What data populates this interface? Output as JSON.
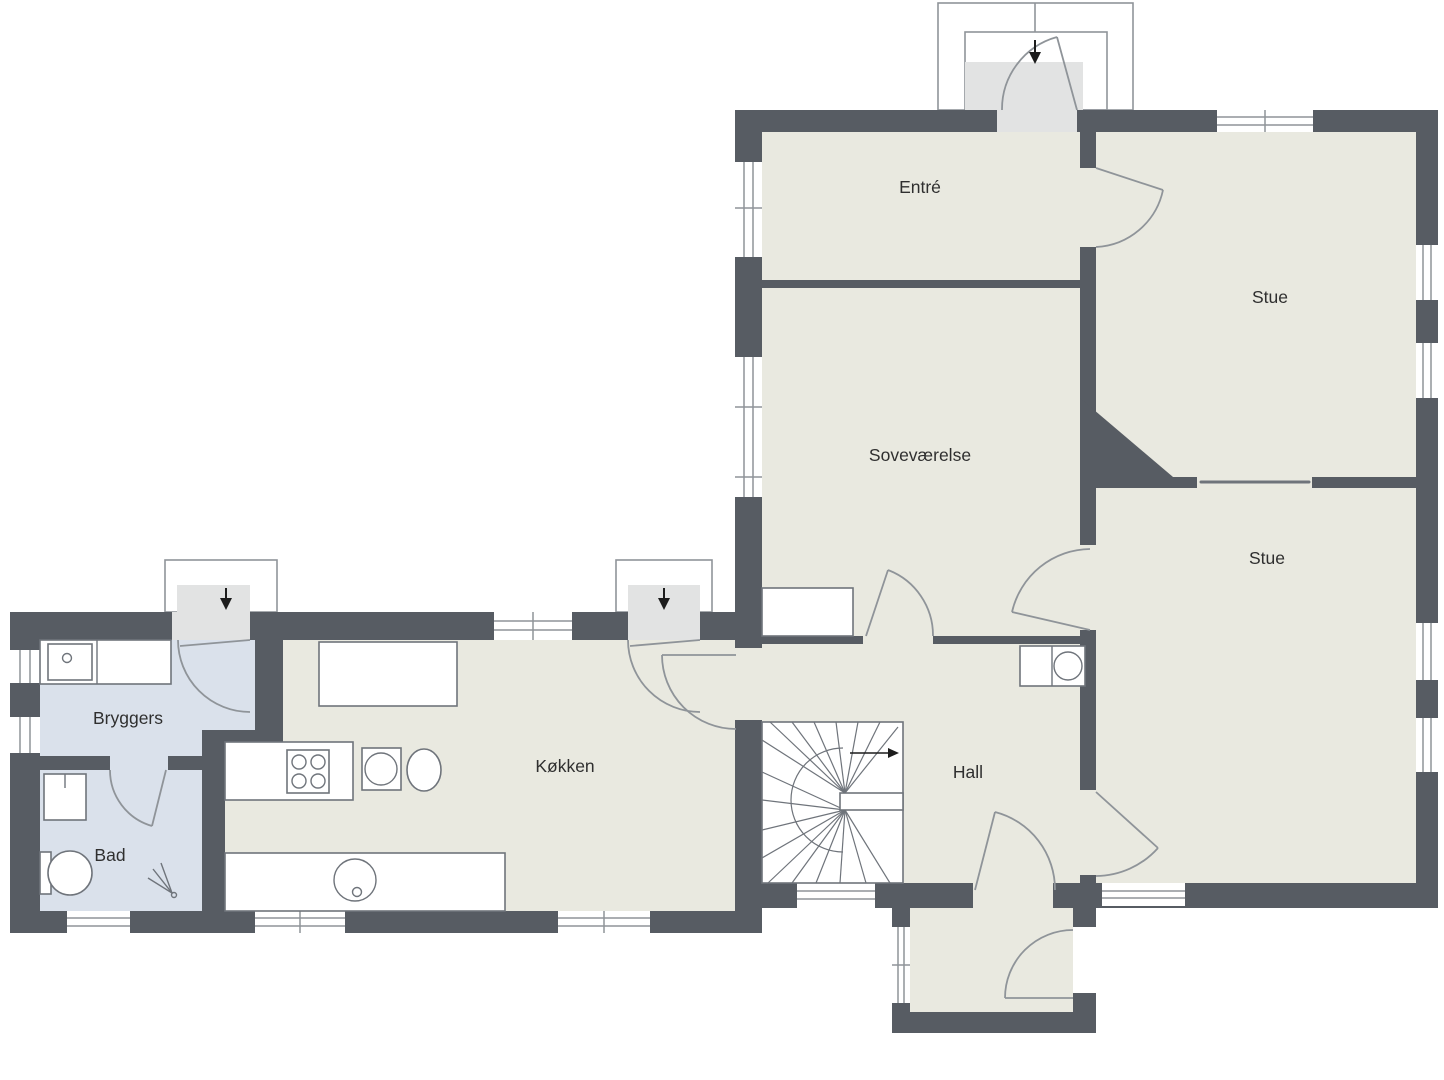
{
  "colors": {
    "wall": "#575c63",
    "floor": "#e9e9e0",
    "wet": "#dae1eb",
    "landing": "#e2e3e3",
    "outline": "#6f747b",
    "line": "#8f9499",
    "arrow": "#1c1c1c",
    "text": "#2f2f2f"
  },
  "rooms": [
    {
      "id": "entre",
      "label": "Entré"
    },
    {
      "id": "stue-upper",
      "label": "Stue"
    },
    {
      "id": "sovevaerelse",
      "label": "Soveværelse"
    },
    {
      "id": "stue-lower",
      "label": "Stue"
    },
    {
      "id": "hall",
      "label": "Hall"
    },
    {
      "id": "koekken",
      "label": "Køkken"
    },
    {
      "id": "bryggers",
      "label": "Bryggers"
    },
    {
      "id": "bad",
      "label": "Bad"
    }
  ]
}
